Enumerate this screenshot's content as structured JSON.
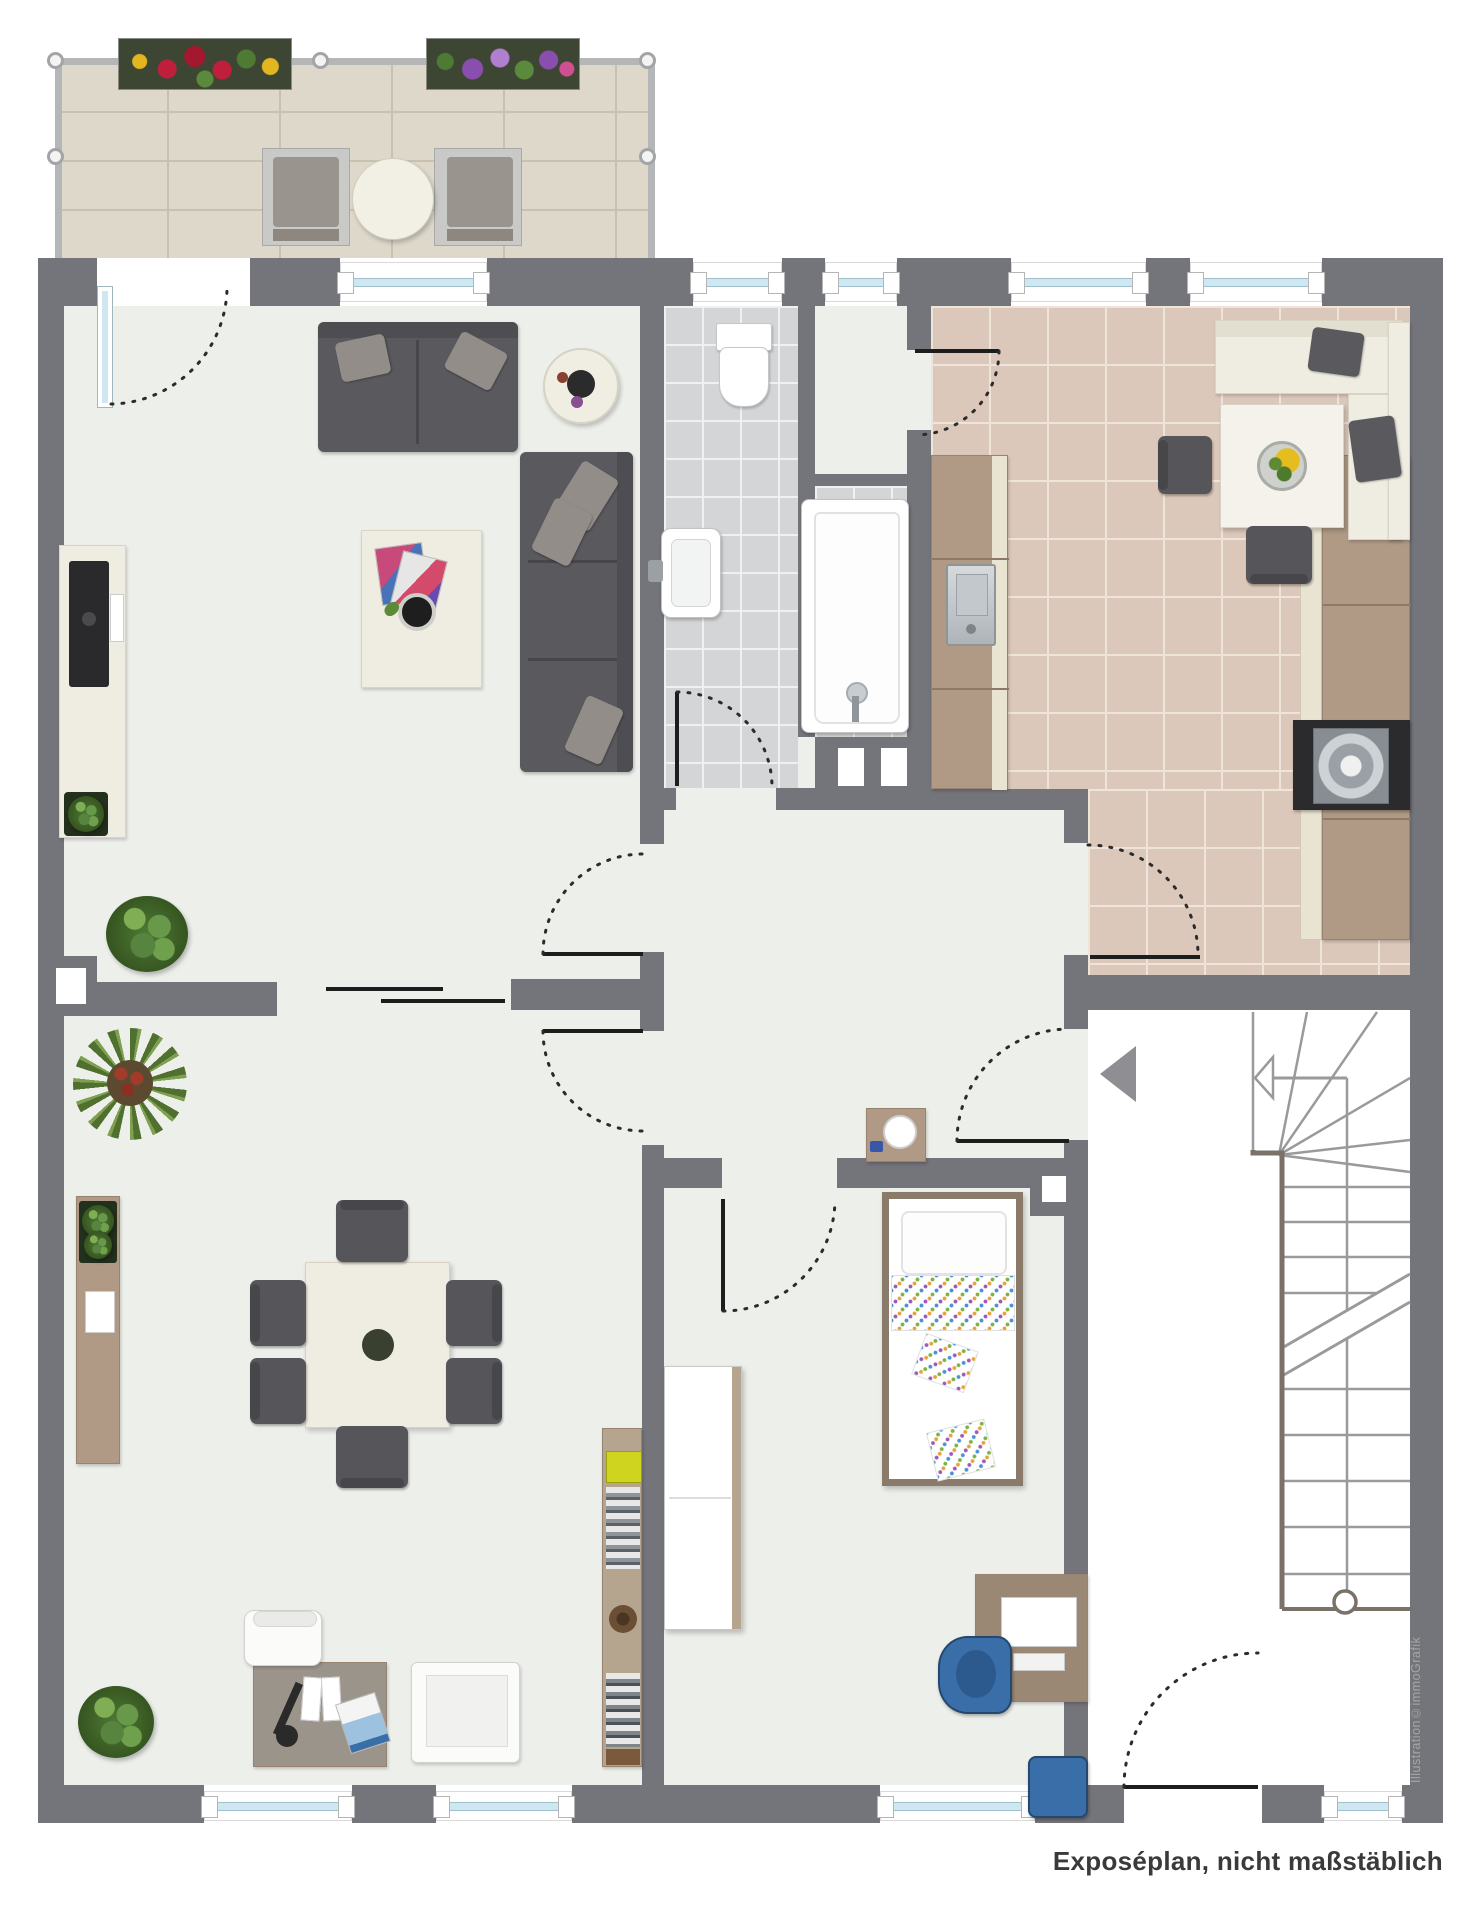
{
  "document": {
    "kind": "apartment floor plan illustration, top-down view, no text labels inside rooms"
  },
  "footer": {
    "note": "Exposéplan, nicht maßstäblich"
  },
  "watermark": {
    "credit": "Illustration©immoGrafik"
  },
  "icons": {
    "entry_marker_icon": "solid left-pointing triangle at apartment entrance",
    "stairs_direction_icon": "open left-pointing arrow with shaft on stair run",
    "door_swing_icon": "dotted quarter-circle arc with solid black door leaf",
    "sliding_door_icon": "two offset parallel black lines between living and dining room"
  },
  "palette": {
    "wall": "#74747b",
    "floor_light": "#edefeb",
    "bath_tile": "#d3d5d7",
    "kitchen_tile": "#dcc8ba",
    "balcony_floor": "#ded8cb",
    "stair_area": "#ffffff",
    "window_glass": "#cfe7f0",
    "furniture_dark_gray": "#5a5a5e",
    "furniture_cream": "#efece1",
    "furniture_wood": "#b09a85",
    "plant_green": "#4e7a35",
    "kid_chair_blue": "#3a6ea8",
    "door_line_black": "#1d1d1d",
    "stair_line_gray": "#9a9a9a",
    "stair_stringer_brown": "#7a7268",
    "marker_gray": "#8f8f93",
    "footer_text": "#3a3a3a",
    "watermark_text": "#a6a6a6"
  },
  "rooms_depicted_count": 8
}
